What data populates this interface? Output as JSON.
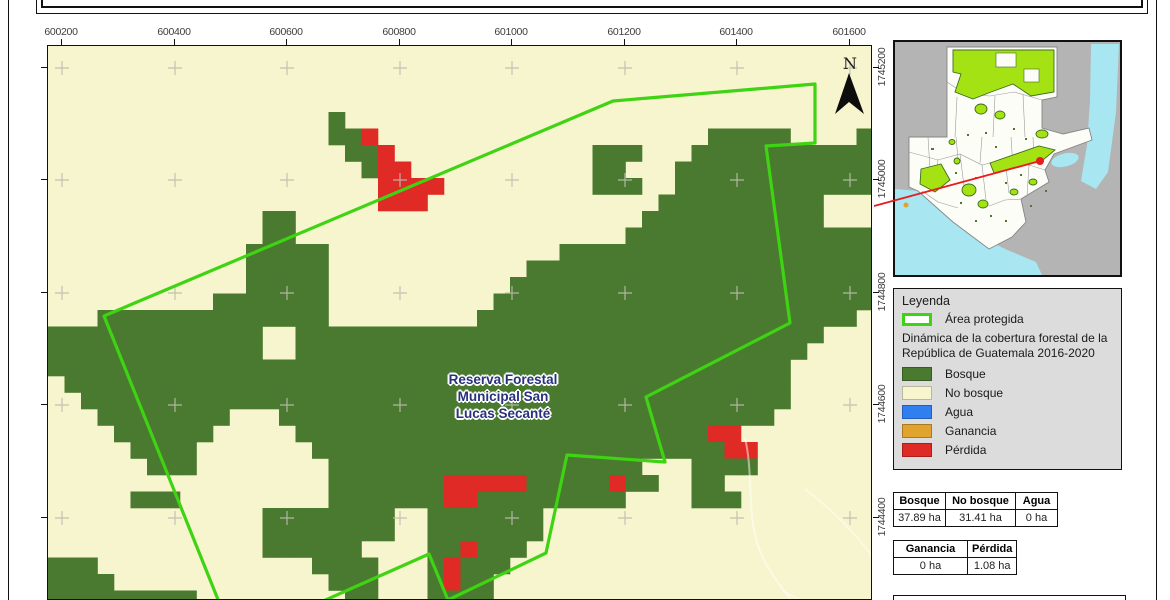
{
  "colors": {
    "bosque": "#4a7a2f",
    "no_bosque": "#f7f5cd",
    "agua": "#2f7ff0",
    "ganancia": "#e0a32e",
    "perdida": "#e02a25",
    "boundary_green": "#3ed313",
    "grid_cross": "#bdbdb0",
    "inset_protected": "#a4e214",
    "inset_water": "#a8e7f2",
    "inset_land_out": "#b4b4b4",
    "red_link": "#e81c1c"
  },
  "map": {
    "north_label": "N",
    "place_label": [
      "Reserva Forestal",
      "Municipal San",
      "Lucas Secanté"
    ],
    "x_ticks": [
      {
        "label": "600200",
        "x": 61
      },
      {
        "label": "600400",
        "x": 174
      },
      {
        "label": "600600",
        "x": 286
      },
      {
        "label": "600800",
        "x": 399
      },
      {
        "label": "601000",
        "x": 511
      },
      {
        "label": "601200",
        "x": 624
      },
      {
        "label": "601400",
        "x": 736
      },
      {
        "label": "601600",
        "x": 849
      }
    ],
    "y_ticks": [
      {
        "label": "1745200",
        "y": 67
      },
      {
        "label": "1745000",
        "y": 179
      },
      {
        "label": "1744800",
        "y": 292
      },
      {
        "label": "1744600",
        "y": 404
      },
      {
        "label": "1744400",
        "y": 517
      }
    ],
    "raster": {
      "cols": 50,
      "rows": 34,
      "cell": 16.5,
      "codes": {
        ".": "no_bosque",
        "B": "bosque",
        "R": "perdida"
      },
      "rows_data": [
        "..................................................",
        "..................................................",
        "..................................................",
        "..................................................",
        ".................B................................",
        ".................BBR....................BBBBB....B",
        "..................BBR............BBB...BBBBBBBBBBB",
        "...................BRR...........BB...BBBBBBBBBBBB",
        "....................RRRR.........BBB..BBBBBBBBBBBB",
        "....................RRR..............BBBBBBBBBB...",
        ".............BB.....................BBBBBBBBBBB...",
        ".............BB....................BBBBBBBBBBBBBBB",
        "............BBBBB..............BBBBBBBBBBBBBBBBBBB",
        "............BBBBB............BBBBBBBBBBBBBBBBBBBBB",
        "............BBBBB...........BBBBBBBBBBBBBBBBBBBBBB",
        "..........BBBBBBB..........BBBBBBBBBBBBBBBBBBBBBBB",
        "...BBBBBBBBBBBBBB.........BBBBBBBBBBBBBBBBBBBBBBB.",
        "BBBBBBBBBBBBB..BBBBBBBBBBBBBBBBBBBBBBBBBBBBBBBB...",
        "BBBBBBBBBBBBB..BBBBBBBBBBBBBBBBBBBBBBBBBBBBBBB....",
        "BBBBBBBBBBBBBBBBBBBBBBBBBBBBBBBBBBBBBBBBBBBBB.....",
        ".BBBBBBBBBBBBBBBBBBBBBBBBBBBBBBBBBBBBBBBBBBBB.....",
        "..BBBBBBBBBBBBBBBBBBBBBBBBBBBBBBBBBBBBBBBBBBB.....",
        "...BBBBBBBB...BBBBBBBBBBBBBBBBBBBBBBBBBBBBBB......",
        "....BBBBBB.....BBBBBBBBBBBBBBBBBBBBBBBBBRR........",
        ".....BBBB.......BBBBBBBBBBBBBBBBBBBBBBBBBRR.......",
        "......BBB........BBBBBBBBBBBBBBBBBBB...BBBB.......",
        ".................BBBBBBBRRRRRBBBBBRBB..BB.........",
        ".....BBB.........BBBBBBBRRBBBBBBBBB....BBB........",
        ".............BBBBBBBB..BBBBBBB....................",
        ".............BBBBBBBB..BBBBBBB....................",
        ".............BBBBBB....BBRBBB.....................",
        "BBB.............BBBB...BRBBB......................",
        "BBBB.............BBB...BRBB.......................",
        "BBBBBBBBB.........BB...BBBB......................."
      ]
    },
    "boundary_px": [
      [
        218,
        601
      ],
      [
        103,
        315
      ],
      [
        612,
        100
      ],
      [
        814,
        83
      ],
      [
        814,
        142
      ],
      [
        765,
        145
      ],
      [
        789,
        322
      ],
      [
        645,
        396
      ],
      [
        664,
        461
      ],
      [
        566,
        454
      ],
      [
        545,
        552
      ],
      [
        447,
        599
      ],
      [
        428,
        553
      ],
      [
        320,
        601
      ]
    ]
  },
  "inset": {
    "red_line": [
      [
        874,
        206
      ],
      [
        1040,
        161
      ]
    ],
    "red_dot": [
      1040,
      161
    ]
  },
  "legend": {
    "title": "Leyenda",
    "protected_label": "Área protegida",
    "dynamics_title": "Dinámica de la cobertura forestal de la República de Guatemala 2016-2020",
    "items": [
      {
        "label": "Bosque",
        "color_key": "bosque"
      },
      {
        "label": "No bosque",
        "color_key": "no_bosque"
      },
      {
        "label": "Agua",
        "color_key": "agua"
      },
      {
        "label": "Ganancia",
        "color_key": "ganancia"
      },
      {
        "label": "Pérdida",
        "color_key": "perdida"
      }
    ]
  },
  "stats_tables": [
    {
      "headers": [
        "Bosque",
        "No bosque",
        "Agua"
      ],
      "values": [
        "37.89 ha",
        "31.41 ha",
        "0 ha"
      ],
      "col_widths": [
        52,
        70,
        42
      ]
    },
    {
      "headers": [
        "Ganancia",
        "Pérdida"
      ],
      "values": [
        "0 ha",
        "1.08 ha"
      ],
      "col_widths": [
        74,
        48
      ]
    }
  ]
}
